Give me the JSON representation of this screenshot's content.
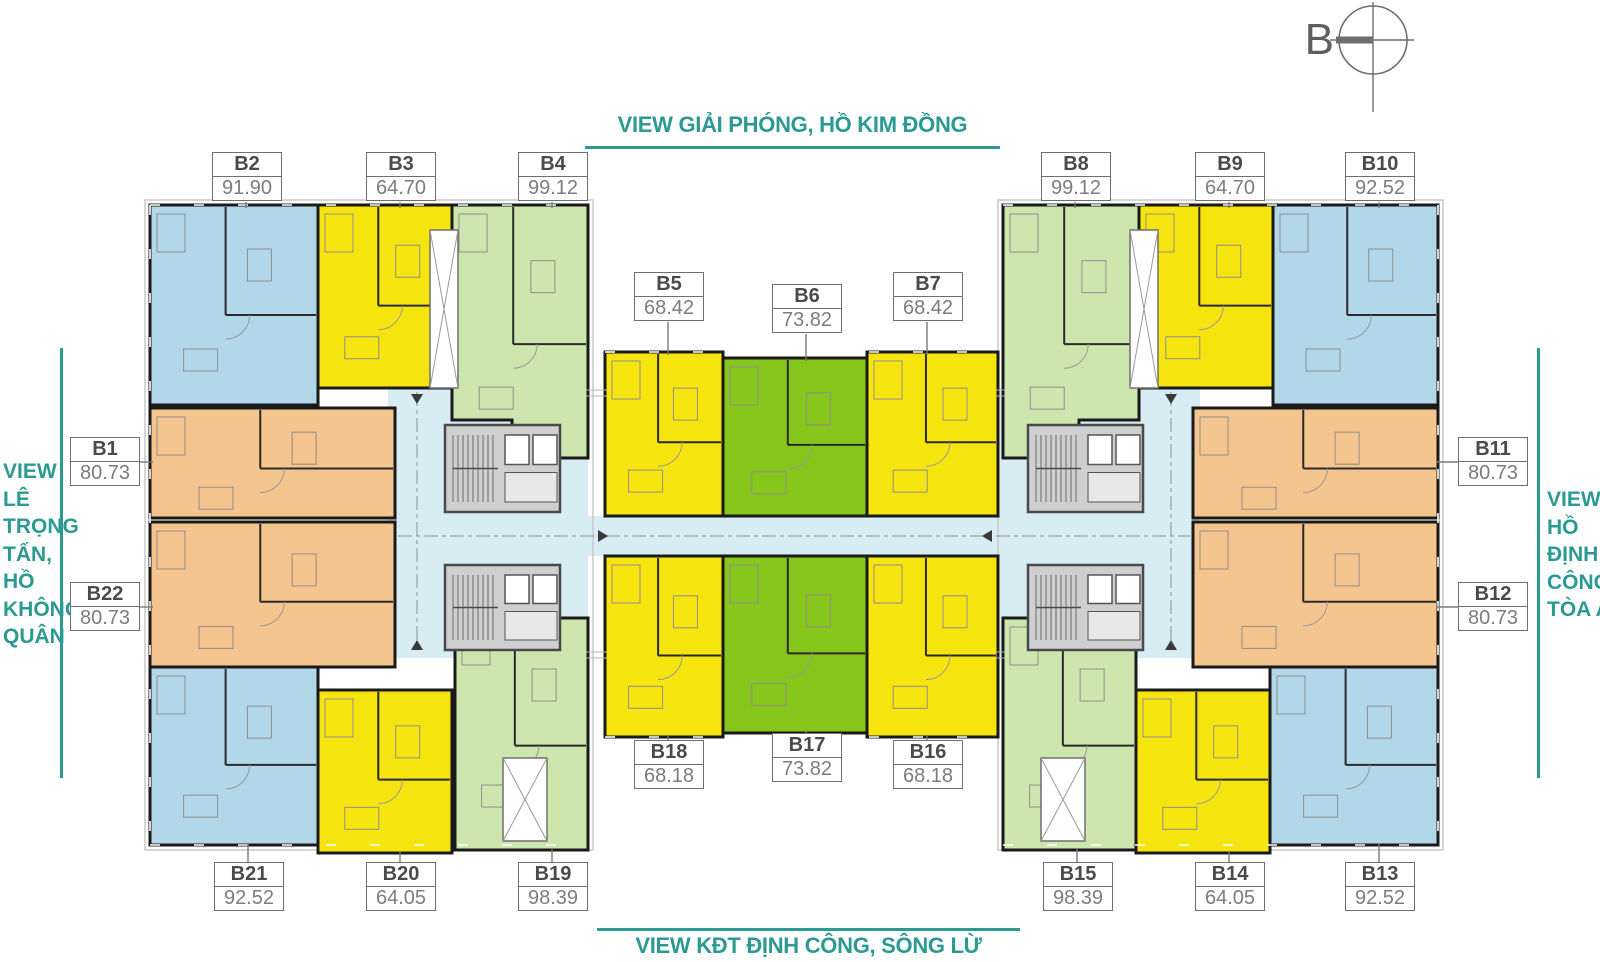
{
  "views": {
    "top": {
      "text": "VIEW GIẢI PHÓNG, HỒ KIM ĐỒNG"
    },
    "bottom": {
      "text": "VIEW KĐT ĐỊNH CÔNG, SÔNG LỪ"
    },
    "left": {
      "lines": [
        "VIEW",
        "LÊ",
        "TRỌNG",
        "TẤN,",
        "HỒ",
        "KHÔNG",
        "QUÂN"
      ]
    },
    "right": {
      "lines": [
        "VIEW",
        "HỒ",
        "ĐỊNH",
        "CÔNG,",
        "TÒA A"
      ]
    }
  },
  "compass": {
    "label": "B"
  },
  "units": [
    {
      "id": "B1",
      "area": "80.73",
      "color": "orange"
    },
    {
      "id": "B2",
      "area": "91.90",
      "color": "blue"
    },
    {
      "id": "B3",
      "area": "64.70",
      "color": "yellow"
    },
    {
      "id": "B4",
      "area": "99.12",
      "color": "green_light"
    },
    {
      "id": "B5",
      "area": "68.42",
      "color": "yellow"
    },
    {
      "id": "B6",
      "area": "73.82",
      "color": "green"
    },
    {
      "id": "B7",
      "area": "68.42",
      "color": "yellow"
    },
    {
      "id": "B8",
      "area": "99.12",
      "color": "green_light"
    },
    {
      "id": "B9",
      "area": "64.70",
      "color": "yellow"
    },
    {
      "id": "B10",
      "area": "92.52",
      "color": "blue"
    },
    {
      "id": "B11",
      "area": "80.73",
      "color": "orange"
    },
    {
      "id": "B12",
      "area": "80.73",
      "color": "orange"
    },
    {
      "id": "B13",
      "area": "92.52",
      "color": "blue"
    },
    {
      "id": "B14",
      "area": "64.05",
      "color": "yellow"
    },
    {
      "id": "B15",
      "area": "98.39",
      "color": "green_light"
    },
    {
      "id": "B16",
      "area": "68.18",
      "color": "yellow"
    },
    {
      "id": "B17",
      "area": "73.82",
      "color": "green"
    },
    {
      "id": "B18",
      "area": "68.18",
      "color": "yellow"
    },
    {
      "id": "B19",
      "area": "98.39",
      "color": "green_light"
    },
    {
      "id": "B20",
      "area": "64.05",
      "color": "yellow"
    },
    {
      "id": "B21",
      "area": "92.52",
      "color": "blue"
    },
    {
      "id": "B22",
      "area": "80.73",
      "color": "orange"
    }
  ],
  "palette": {
    "blue": "#b1d7e8",
    "yellow": "#f6e40e",
    "green_light": "#cde6ae",
    "green": "#86c51a",
    "orange": "#f4c58e",
    "corridor": "#d8ecf4",
    "teal": "#2a9a92",
    "wall": "#1a1a1a",
    "core_fill": "#cfcfcf",
    "core_line": "#4a4a4a",
    "label_border": "#6f6f6f"
  }
}
